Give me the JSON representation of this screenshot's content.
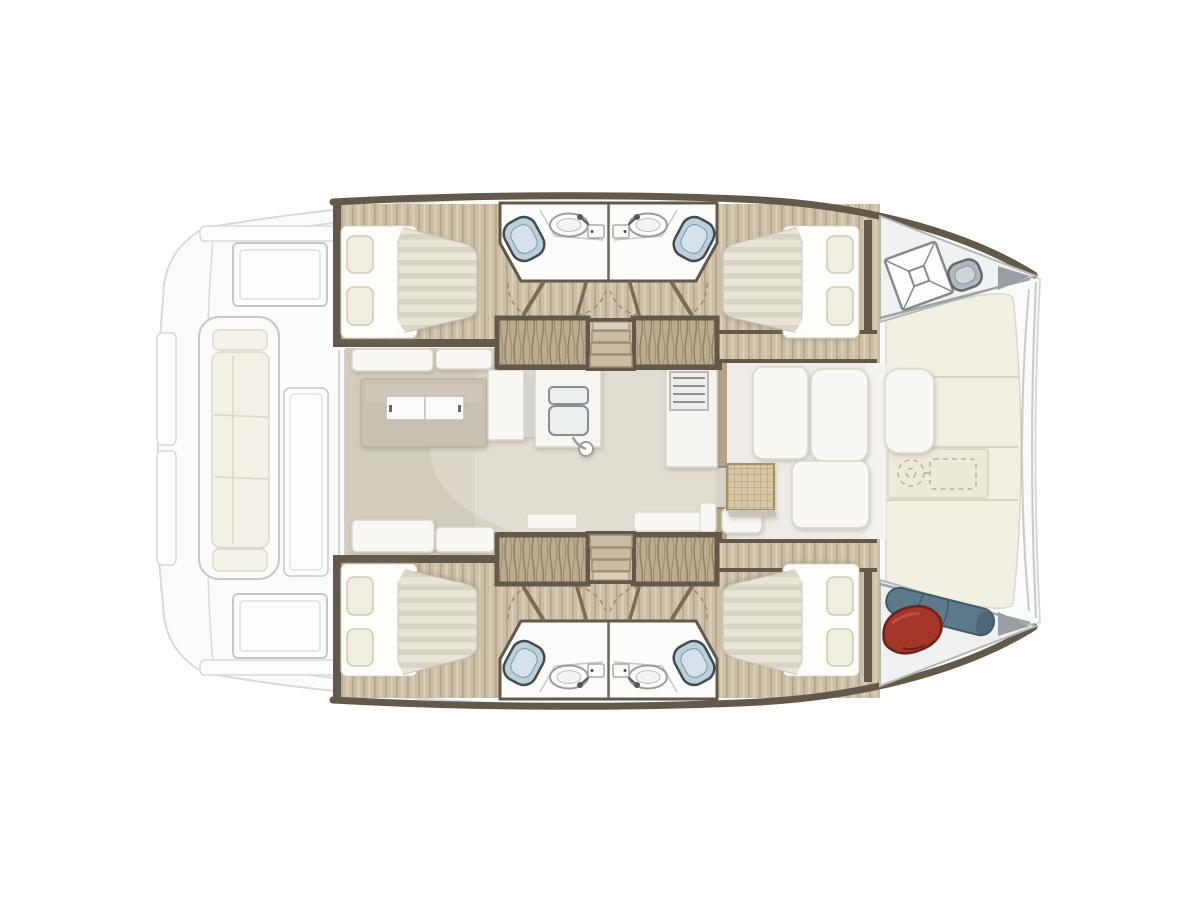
{
  "boat": {
    "type": "catamaran",
    "view": "top-down interior floor plan",
    "orientation": "bow-right-stern-left",
    "cabins_count": "4",
    "bathrooms_count": "4"
  },
  "palette": {
    "bg": "#ffffff",
    "ghost_fill": "#fafbfb",
    "ghost_stroke": "#d6dadb",
    "ghost_stroke2": "#c3c8c9",
    "cushion": "#f2f0e7",
    "cushion_stroke": "#dbd8ca",
    "deck_ivory": "#f2efe3",
    "deck_seam": "#d8d4c5",
    "deck_recess": "#eeeadb",
    "sketch": "#b7b2a2",
    "trim_dark": "#63594b",
    "wood_floor": "#cdbfa6",
    "wood_line": "#b7a88d",
    "wood_light": "#dbcfb8",
    "wood_band": "#b3a489",
    "wardrobe_base": "#bcac8f",
    "wardrobe_line": "#8f7f61",
    "step_fill": "#cabca4",
    "step_riser": "#9c8d75",
    "saloon_floor": "#dad4c6",
    "saloon_floor_dark": "#ccc5b4",
    "fwd_floor": "#edece6",
    "white_furn": "#f9f8f4",
    "furn_stroke": "#d9d7cc",
    "island": "#c8c1b2",
    "island_light": "#d5cfc1",
    "mattress": "#e8e4d7",
    "mattress_stripe": "#d9d5c6",
    "sheet": "#fdfdfa",
    "pillow": "#f1eee2",
    "pillow_stroke": "#cfc9b7",
    "bath_floor": "#fcfcfa",
    "bath_wall": "#6b655a",
    "toilet_fill": "#bcd0dc",
    "toilet_dark": "#454a51",
    "toilet_light": "#d6e2ea",
    "sink_stroke": "#999c9d",
    "metal": "#b0b9bd",
    "metal_dark": "#646b6f",
    "metal_light": "#ced5d7",
    "red_bag": "#a53529",
    "red_dark": "#6f221b",
    "red_light": "#c05949",
    "blue_roll": "#5d7a8c",
    "blue_dark": "#425a68",
    "woven": "#d6c7a6",
    "woven_line": "#b19b74",
    "hatch_stroke": "#868a8c",
    "door_leaf": "#7c6c50",
    "door_dash": "#9b8c72"
  },
  "structure": {
    "aft_cockpit": [
      "stern-swim-steps",
      "aft-crossbeam",
      "cockpit-bench-sofa",
      "cockpit-box-top",
      "cockpit-box-bottom",
      "cockpit-table"
    ],
    "saloon": [
      "sofa-top",
      "sofa-bottom",
      "galley-island-table",
      "galley-cabinet",
      "double-sink",
      "faucet",
      "stove-oven-unit",
      "forward-door-opening"
    ],
    "hull_port": [
      "aft-double-bed",
      "bathroom-with-toilet-and-sink",
      "bathroom-with-toilet-and-sink",
      "wardrobe",
      "wardrobe",
      "companionway-steps",
      "forward-double-bed",
      "bow-locker-hatch",
      "bow-windlass"
    ],
    "hull_starboard": [
      "aft-double-bed",
      "bathroom-with-toilet-and-sink",
      "bathroom-with-toilet-and-sink",
      "wardrobe",
      "wardrobe",
      "companionway-steps",
      "forward-double-bed",
      "bow-locker-red-fender",
      "bow-locker-blue-sail-bag"
    ],
    "foredeck": [
      "deck-panels",
      "windlass-outline-sketch",
      "forward-crossbeam-arcs"
    ],
    "forward_cockpit": [
      "seat",
      "seat",
      "seat",
      "seat",
      "woven-top-table"
    ]
  }
}
